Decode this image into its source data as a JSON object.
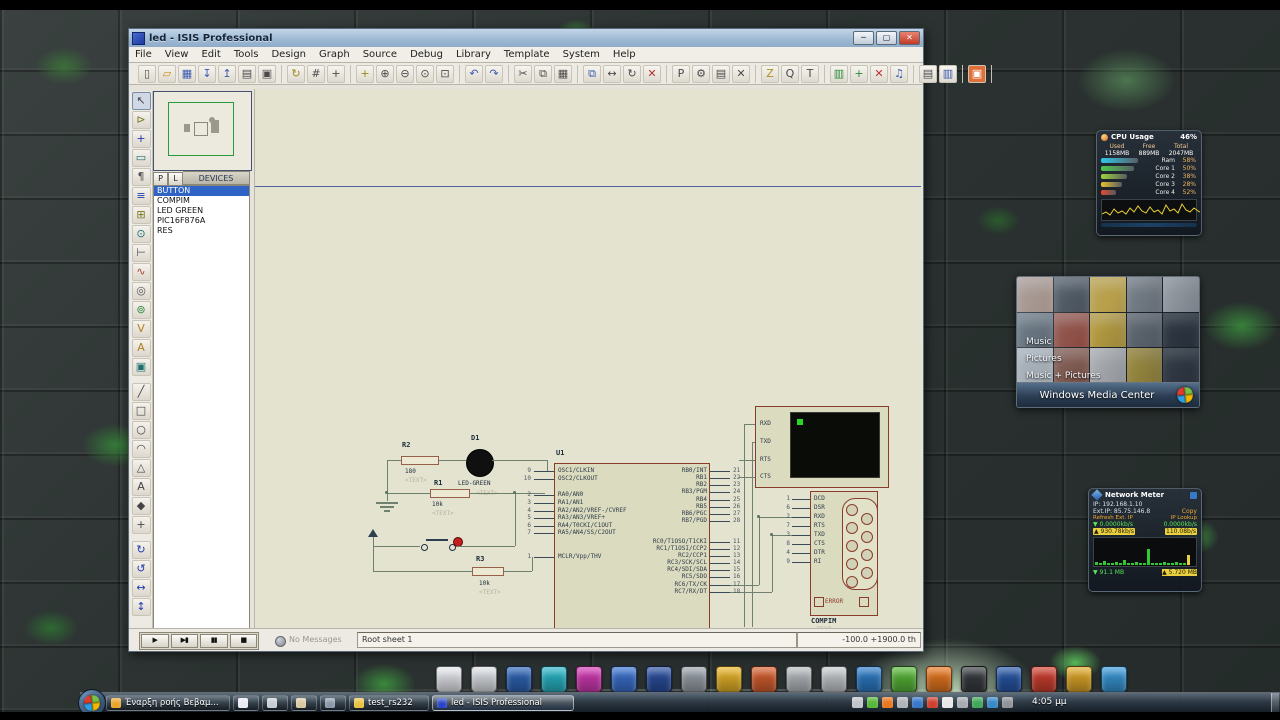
{
  "window": {
    "title": "led - ISIS Professional",
    "menu": [
      "File",
      "View",
      "Edit",
      "Tools",
      "Design",
      "Graph",
      "Source",
      "Debug",
      "Library",
      "Template",
      "System",
      "Help"
    ],
    "titlebar_buttons": {
      "minimize": "─",
      "maximize": "▢",
      "close": "✕"
    },
    "toolbar": [
      [
        {
          "n": "new-file-icon",
          "g": "▯"
        },
        {
          "n": "open-file-icon",
          "g": "▱",
          "c": "#c89018"
        },
        {
          "n": "save-file-icon",
          "g": "▦",
          "c": "#3a58b0"
        },
        {
          "n": "import-icon",
          "g": "↧",
          "c": "#3a58b0"
        },
        {
          "n": "export-icon",
          "g": "↥",
          "c": "#3a58b0"
        },
        {
          "n": "print-icon",
          "g": "▤"
        },
        {
          "n": "mark-area-icon",
          "g": "▣"
        }
      ],
      [
        {
          "n": "refresh-icon",
          "g": "↻",
          "c": "#9a8a20"
        },
        {
          "n": "grid-toggle-icon",
          "g": "#"
        },
        {
          "n": "origin-icon",
          "g": "+"
        }
      ],
      [
        {
          "n": "pan-icon",
          "g": "+",
          "c": "#9a8a20"
        },
        {
          "n": "zoom-in-icon",
          "g": "⊕"
        },
        {
          "n": "zoom-out-icon",
          "g": "⊖"
        },
        {
          "n": "zoom-all-icon",
          "g": "⊙"
        },
        {
          "n": "zoom-area-icon",
          "g": "⊡"
        }
      ],
      [
        {
          "n": "undo-icon",
          "g": "↶",
          "c": "#3a58b0"
        },
        {
          "n": "redo-icon",
          "g": "↷",
          "c": "#3a58b0"
        }
      ],
      [
        {
          "n": "cut-icon",
          "g": "✂"
        },
        {
          "n": "copy-icon",
          "g": "⧉"
        },
        {
          "n": "paste-icon",
          "g": "▦"
        }
      ],
      [
        {
          "n": "block-copy-icon",
          "g": "⧉",
          "c": "#3a58b0"
        },
        {
          "n": "block-move-icon",
          "g": "↔"
        },
        {
          "n": "block-rotate-icon",
          "g": "↻"
        },
        {
          "n": "block-delete-icon",
          "g": "✕",
          "c": "#b03030"
        }
      ],
      [
        {
          "n": "pick-device-icon",
          "g": "P"
        },
        {
          "n": "make-device-icon",
          "g": "⚙"
        },
        {
          "n": "packaging-icon",
          "g": "▤"
        },
        {
          "n": "decompose-icon",
          "g": "✕"
        }
      ],
      [
        {
          "n": "wire-autorouter-icon",
          "g": "Z",
          "c": "#b09020"
        },
        {
          "n": "search-tag-icon",
          "g": "Q"
        },
        {
          "n": "property-tool-icon",
          "g": "T"
        }
      ],
      [
        {
          "n": "design-explorer-icon",
          "g": "▥",
          "c": "#2a8a3a"
        },
        {
          "n": "new-sheet-icon",
          "g": "+",
          "c": "#2a8a3a"
        },
        {
          "n": "remove-sheet-icon",
          "g": "✕",
          "c": "#c03030"
        },
        {
          "n": "goto-sheet-icon",
          "g": "♫",
          "c": "#3a58b0"
        }
      ],
      [
        {
          "n": "bom-icon",
          "g": "▤"
        },
        {
          "n": "erc-icon",
          "g": "▥",
          "c": "#3a58b0"
        }
      ],
      [
        {
          "n": "netlist-transfer-icon",
          "g": "▣",
          "c": "#ffffff",
          "bg": "#e07038"
        }
      ]
    ],
    "left_tools": [
      {
        "n": "selection-pointer-icon",
        "g": "↖"
      },
      {
        "n": "component-mode-icon",
        "g": "⊳",
        "c": "#7a7a20"
      },
      {
        "n": "junction-dot-icon",
        "g": "+",
        "c": "#2038b0"
      },
      {
        "n": "wire-label-icon",
        "g": "▭",
        "c": "#207070"
      },
      {
        "n": "text-script-icon",
        "g": "¶",
        "c": "#555555"
      },
      {
        "n": "bus-icon",
        "g": "≡",
        "c": "#2038b0"
      },
      {
        "n": "subcircuit-icon",
        "g": "⊞",
        "c": "#7a7a20"
      },
      {
        "n": "terminal-mode-icon",
        "g": "⊙",
        "c": "#207070"
      },
      {
        "n": "device-pin-icon",
        "g": "⊢",
        "c": "#555555"
      },
      {
        "n": "graph-mode-icon",
        "g": "∿",
        "c": "#b04030"
      },
      {
        "n": "tape-recorder-icon",
        "g": "◎",
        "c": "#555555"
      },
      {
        "n": "generator-icon",
        "g": "⊚",
        "c": "#2a8a3a"
      },
      {
        "n": "voltage-probe-icon",
        "g": "V",
        "c": "#b08020"
      },
      {
        "n": "current-probe-icon",
        "g": "A",
        "c": "#b08020"
      },
      {
        "n": "virtual-instrument-icon",
        "g": "▣",
        "c": "#207070"
      },
      {
        "sep": 1
      },
      {
        "n": "2d-line-icon",
        "g": "╱"
      },
      {
        "n": "2d-box-icon",
        "g": "□"
      },
      {
        "n": "2d-circle-icon",
        "g": "○"
      },
      {
        "n": "2d-arc-icon",
        "g": "◠"
      },
      {
        "n": "2d-path-icon",
        "g": "△"
      },
      {
        "n": "2d-text-icon",
        "g": "A"
      },
      {
        "n": "2d-symbol-icon",
        "g": "◆"
      },
      {
        "n": "2d-marker-icon",
        "g": "+"
      },
      {
        "sep": 1
      },
      {
        "n": "rotate-cw-icon",
        "g": "↻",
        "c": "#2038b0"
      },
      {
        "n": "rotate-ccw-icon",
        "g": "↺",
        "c": "#2038b0"
      },
      {
        "n": "mirror-h-icon",
        "g": "↔",
        "c": "#2038b0"
      },
      {
        "n": "mirror-v-icon",
        "g": "↕",
        "c": "#2038b0"
      }
    ],
    "devices": {
      "pick_button": "P",
      "library_button": "L",
      "header": "DEVICES",
      "items": [
        "BUTTON",
        "COMPIM",
        "LED GREEN",
        "PIC16F876A",
        "RES"
      ],
      "selected_index": 0
    },
    "sim_controls": [
      {
        "n": "play-button",
        "g": "▶"
      },
      {
        "n": "step-button",
        "g": "▶▮"
      },
      {
        "n": "pause-button",
        "g": "▮▮"
      },
      {
        "n": "stop-button",
        "g": "■"
      }
    ],
    "statusbar": {
      "message": "No Messages",
      "sheet": "Root sheet 1",
      "coords": "-100.0   +1900.0   th"
    }
  },
  "schematic": {
    "r2": {
      "ref": "R2",
      "value": "180",
      "text": "<TEXT>"
    },
    "r1": {
      "ref": "R1",
      "value": "10k",
      "text": "<TEXT>"
    },
    "r3": {
      "ref": "R3",
      "value": "10k",
      "text": "<TEXT>"
    },
    "d1": {
      "ref": "D1",
      "value": "LED-GREEN",
      "text": "<TEXT>"
    },
    "u1": {
      "ref": "U1",
      "left_pins": [
        [
          "9",
          "OSC1/CLKIN"
        ],
        [
          "10",
          "OSC2/CLKOUT"
        ],
        [
          "2",
          "RA0/AN0"
        ],
        [
          "3",
          "RA1/AN1"
        ],
        [
          "4",
          "RA2/AN2/VREF-/CVREF"
        ],
        [
          "5",
          "RA3/AN3/VREF+"
        ],
        [
          "6",
          "RA4/T0CKI/C1OUT"
        ],
        [
          "7",
          "RA5/AN4/SS/C2OUT"
        ],
        [
          "1",
          "MCLR/Vpp/THV"
        ]
      ],
      "right_pins": [
        [
          "21",
          "RB0/INT"
        ],
        [
          "22",
          "RB1"
        ],
        [
          "23",
          "RB2"
        ],
        [
          "24",
          "RB3/PGM"
        ],
        [
          "25",
          "RB4"
        ],
        [
          "26",
          "RB5"
        ],
        [
          "27",
          "RB6/PGC"
        ],
        [
          "28",
          "RB7/PGD"
        ],
        [
          "11",
          "RC0/T1OSO/T1CKI"
        ],
        [
          "12",
          "RC1/T1OSI/CCP2"
        ],
        [
          "13",
          "RC2/CCP1"
        ],
        [
          "14",
          "RC3/SCK/SCL"
        ],
        [
          "15",
          "RC4/SDI/SDA"
        ],
        [
          "16",
          "RC5/SDO"
        ],
        [
          "17",
          "RC6/TX/CK"
        ],
        [
          "18",
          "RC7/RX/DT"
        ]
      ]
    },
    "terminal": {
      "pins": [
        "RXD",
        "TXD",
        "RTS",
        "CTS"
      ]
    },
    "compim": {
      "ref": "COMPIM",
      "text": "<TEXT>",
      "error": "ERROR",
      "pins": [
        [
          "1",
          "DCD"
        ],
        [
          "6",
          "DSR"
        ],
        [
          "2",
          "RXD"
        ],
        [
          "7",
          "RTS"
        ],
        [
          "3",
          "TXD"
        ],
        [
          "8",
          "CTS"
        ],
        [
          "4",
          "DTR"
        ],
        [
          "9",
          "RI"
        ]
      ]
    }
  },
  "gadgets": {
    "cpu": {
      "title": "CPU Usage",
      "usage": "46%",
      "columns": [
        "Used",
        "Free",
        "Total"
      ],
      "values": [
        "1158MB",
        "889MB",
        "2047MB"
      ],
      "rows": [
        {
          "label": "Ram",
          "pct": "58%",
          "frac": 0.74,
          "color": "#2ec8e8"
        },
        {
          "label": "Core 1",
          "pct": "50%",
          "frac": 0.66,
          "color": "#4fc84f"
        },
        {
          "label": "Core 2",
          "pct": "38%",
          "frac": 0.52,
          "color": "#9fd23a"
        },
        {
          "label": "Core 3",
          "pct": "28%",
          "frac": 0.42,
          "color": "#e8c22e"
        },
        {
          "label": "Core 4",
          "pct": "52%",
          "frac": 0.3,
          "color": "#e84b2e"
        }
      ]
    },
    "media": {
      "items": [
        "Music",
        "Pictures",
        "Music + Pictures"
      ],
      "title": "Windows Media Center"
    },
    "net": {
      "title": "Network Meter",
      "ip": "IP: 192.168.1.10",
      "ext_ip": "Ext.IP: 85.75.146.8",
      "copy": "Copy",
      "col_left": "Refresh Ext. IP",
      "col_right": "IP Lookup",
      "down_a": "▼ 0.0000kb/s",
      "down_b": "0.0000kb/s",
      "up_a": "▲ 930.78kb/s",
      "up_b": "110.08b/s",
      "total_down": "▼ 91.1 MB",
      "total_up": "▲ 5.720 MB"
    }
  },
  "taskbar": {
    "buttons": [
      {
        "label": "Έναρξη ροής Βεβαμ...",
        "icon": "#e8a428"
      },
      {
        "icon": "#e8eaf0"
      },
      {
        "icon": "#c8ccd4"
      },
      {
        "icon": "#d8c8a0"
      },
      {
        "icon": "#8898a8"
      },
      {
        "label": "test_rs232",
        "icon": "#e8c040"
      },
      {
        "label": "led - ISIS Professional",
        "icon": "#2844c8",
        "active": true
      }
    ],
    "clock": "4:05 μμ"
  }
}
